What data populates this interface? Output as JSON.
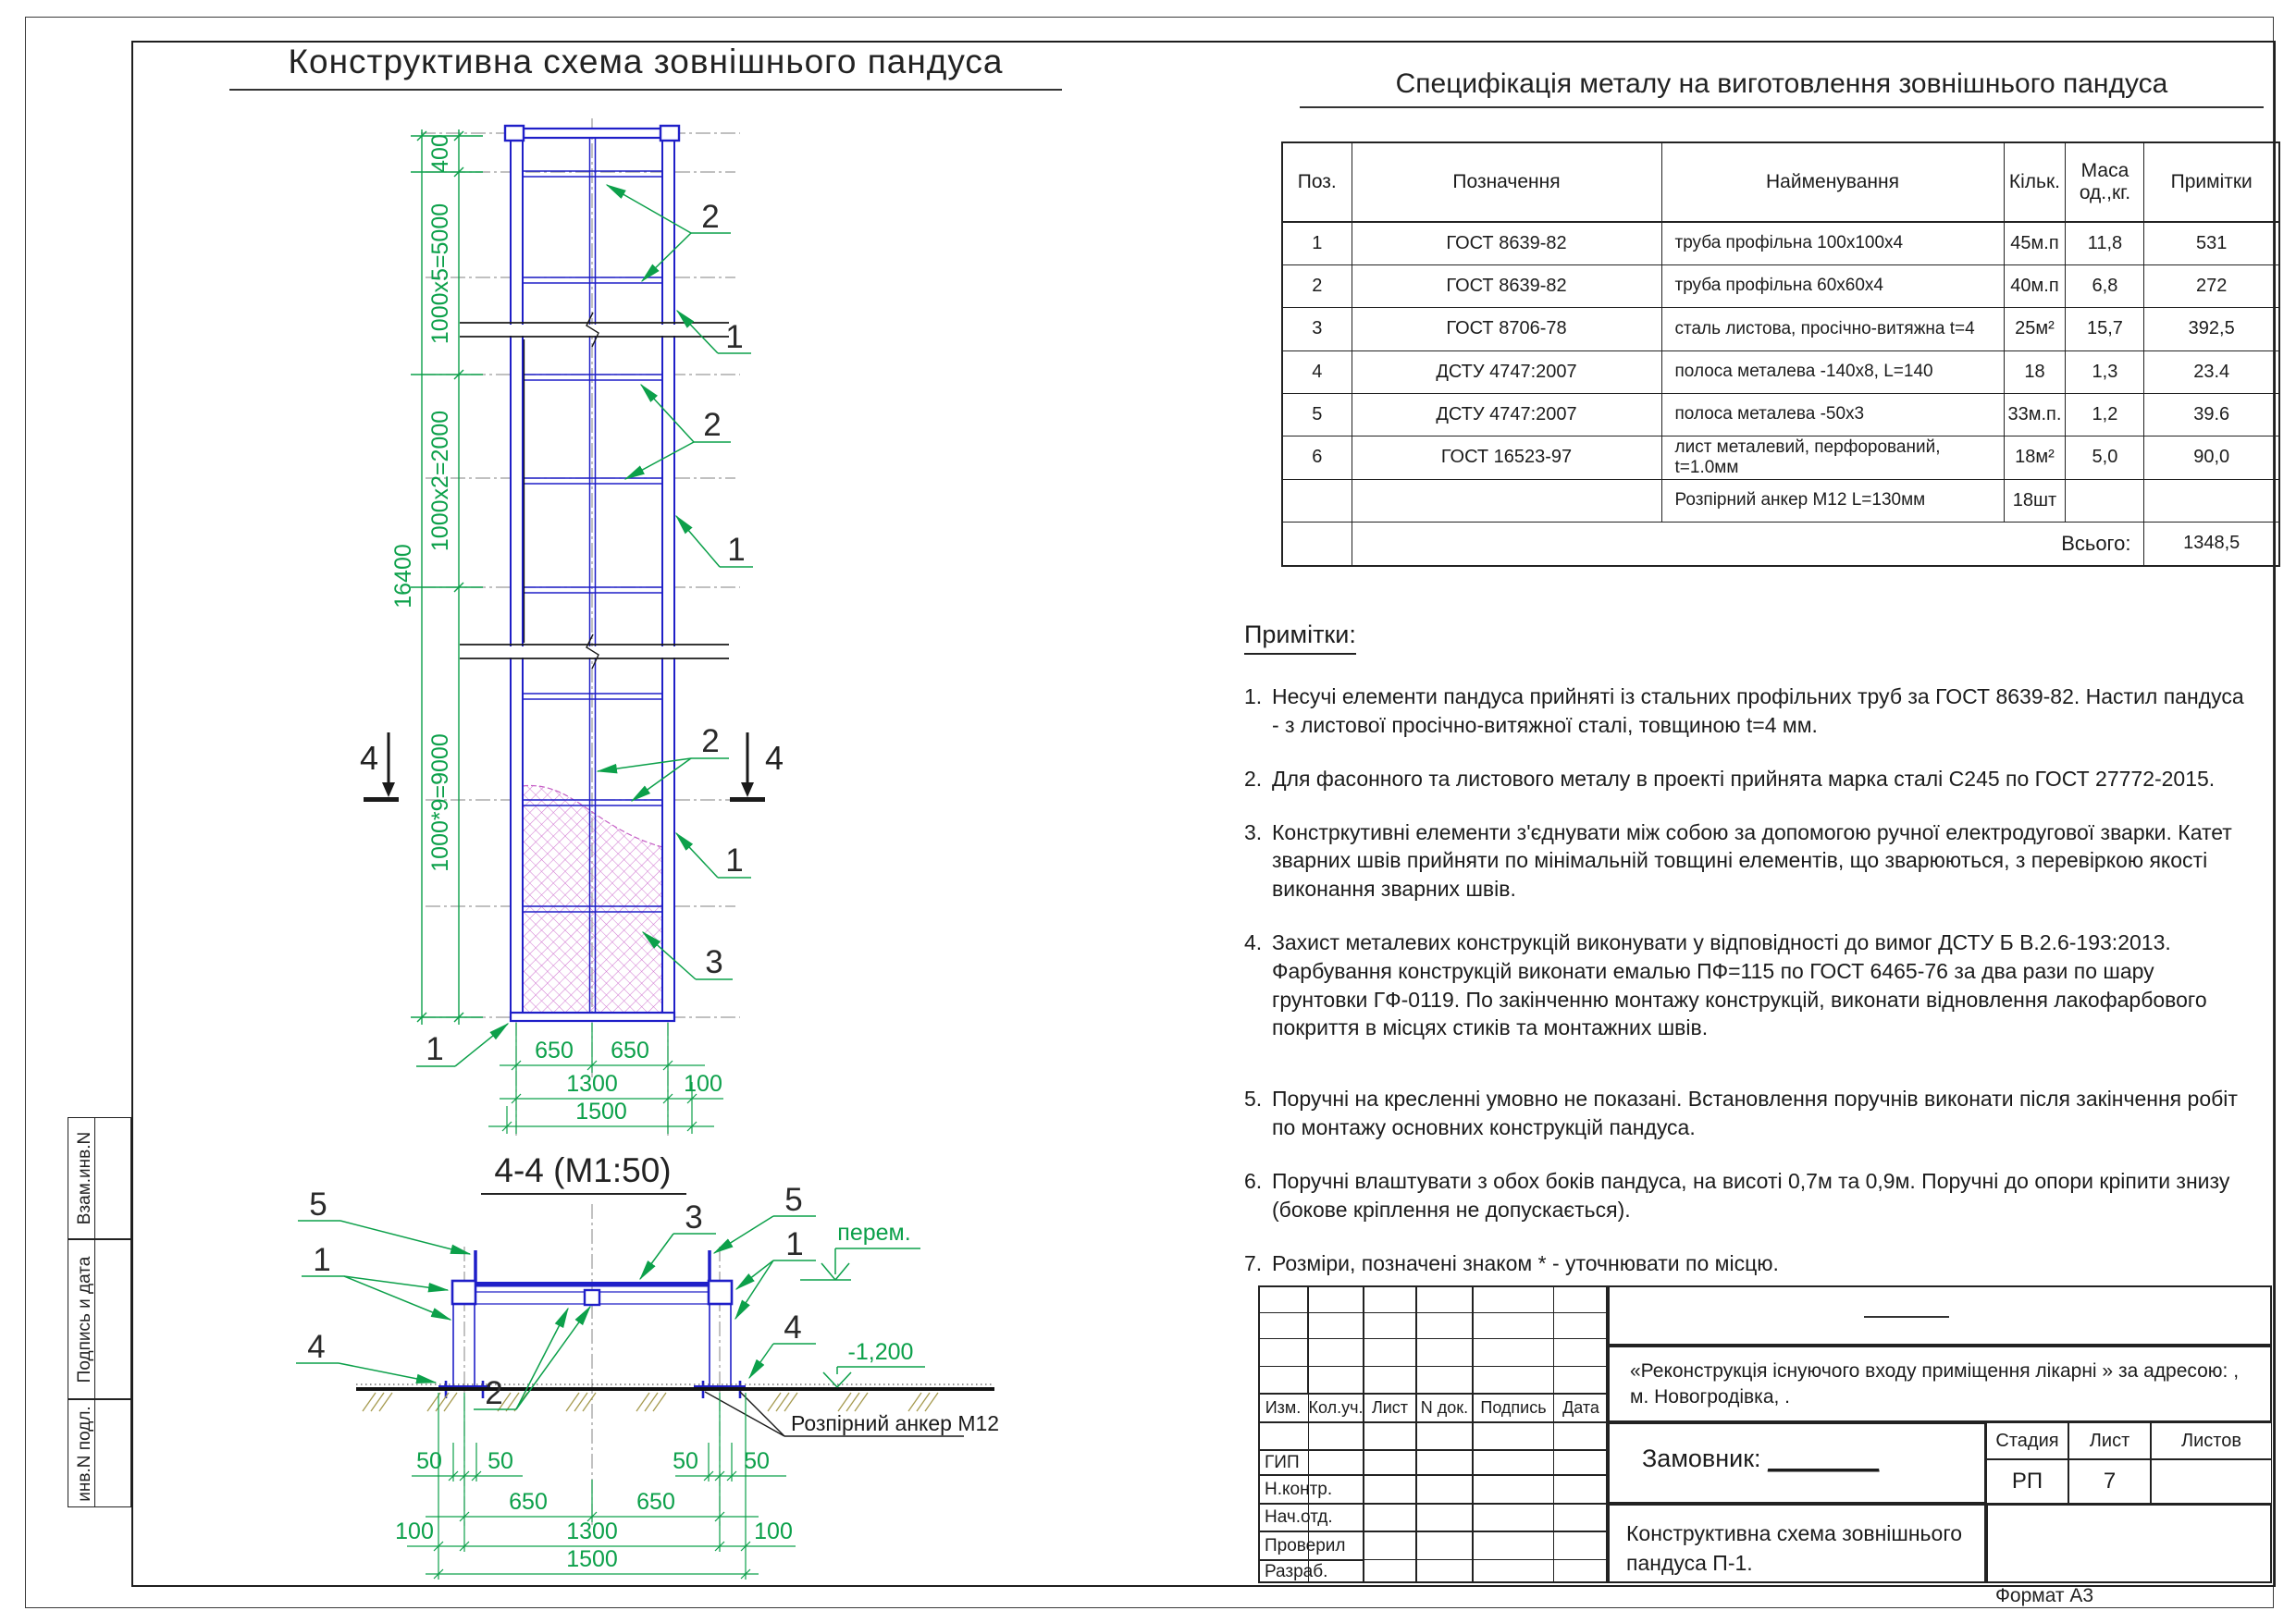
{
  "sheet": {
    "main_title": "Конструктивна схема зовнішнього пандуса",
    "format_label": "Формат А3"
  },
  "side_stamps": {
    "s1": "Взам.инв.N",
    "s2": "Подпись и дата",
    "s3": "инв.N подл."
  },
  "spec_table": {
    "title": "Специфікація металу на виготовлення зовнішнього пандуса",
    "headers": {
      "pos": "Поз.",
      "designation": "Позначення",
      "name": "Найменування",
      "qty": "Кільк.",
      "mass": "Маса од.,кг.",
      "notes": "Примітки"
    },
    "rows": [
      {
        "pos": "1",
        "designation": "ГОСТ 8639-82",
        "name": "труба профільна  100х100х4",
        "qty": "45м.п",
        "mass": "11,8",
        "notes": "531"
      },
      {
        "pos": "2",
        "designation": "ГОСТ 8639-82",
        "name": "труба профільна  60х60х4",
        "qty": "40м.п",
        "mass": "6,8",
        "notes": "272"
      },
      {
        "pos": "3",
        "designation": "ГОСТ 8706-78",
        "name": "сталь листова, просічно-витяжна t=4",
        "qty": "25м²",
        "mass": "15,7",
        "notes": "392,5"
      },
      {
        "pos": "4",
        "designation": "ДСТУ 4747:2007",
        "name": "полоса металева -140х8, L=140",
        "qty": "18",
        "mass": "1,3",
        "notes": "23.4"
      },
      {
        "pos": "5",
        "designation": "ДСТУ 4747:2007",
        "name": "полоса металева -50х3",
        "qty": "33м.п.",
        "mass": "1,2",
        "notes": "39.6"
      },
      {
        "pos": "6",
        "designation": "ГОСТ 16523-97",
        "name": "лист металевий, перфорований, t=1.0мм",
        "qty": "18м²",
        "mass": "5,0",
        "notes": "90,0"
      },
      {
        "pos": "",
        "designation": "",
        "name": "Розпірний анкер М12 L=130мм",
        "qty": "18шт",
        "mass": "",
        "notes": ""
      }
    ],
    "total_label": "Всього:",
    "total_value": "1348,5"
  },
  "notes": {
    "title": "Примітки:",
    "items": [
      {
        "num": "1.",
        "text": "Несучі елементи пандуса прийняті із стальних профільних труб за ГОСТ 8639-82. Настил пандуса - з листової просічно-витяжної сталі, товщиною t=4 мм."
      },
      {
        "num": "2.",
        "text": "Для фасонного та листового металу в проекті прийнята марка сталі С245 по ГОСТ 27772-2015."
      },
      {
        "num": "3.",
        "text": "Констркутивні елементи з'єднувати між собою за допомогою ручної електродугової зварки. Катет зварних швів прийняти по мінімальній товщині елементів, що зварюються, з перевіркою якості виконання зварних швів."
      },
      {
        "num": "4.",
        "text": "Захист металевих конструкцій виконувати у відповідності до вимог ДСТУ Б В.2.6-193:2013. Фарбування конструкцій виконати емалью ПФ=115 по ГОСТ 6465-76 за два рази по шару грунтовки ГФ-0119. По закінченню монтажу конструкцій, виконати відновлення лакофарбового покриття в місцях стиків та монтажних швів."
      },
      {
        "num": "5.",
        "text": "Поручні на кресленні умовно не показані. Встановлення поручнів виконати після закінчення робіт по монтажу основних конструкцій пандуса."
      },
      {
        "num": "6.",
        "text": "Поручні влаштувати з обох боків пандуса, на висоті 0,7м та 0,9м. Поручні до опори  кріпити знизу (бокове кріплення не допускається)."
      },
      {
        "num": "7.",
        "text": "Розміри, позначені знаком * - уточнювати по місцю."
      }
    ]
  },
  "labels": {
    "n1": "1",
    "n2": "2",
    "n3": "3",
    "n4": "4",
    "n5": "5"
  },
  "elevation": {
    "dim_400": "400",
    "dim_5000": "1000х5=5000",
    "dim_2000": "1000х2=2000",
    "dim_9000": "1000*9=9000",
    "dim_total": "16400",
    "dim_650": "650",
    "dim_1300": "1300",
    "dim_100": "100",
    "dim_1500": "1500"
  },
  "section": {
    "title": "4-4 (М1:50)",
    "dim_50": "50",
    "dim_650": "650",
    "dim_100": "100",
    "dim_1300": "1300",
    "dim_1500": "1500",
    "level_top": "перем.",
    "level_bottom": "-1,200",
    "anchor_label": "Розпірний анкер М12"
  },
  "title_block": {
    "header_cols": {
      "c1": "Изм.",
      "c2": "Кол.уч.",
      "c3": "Лист",
      "c4": "N док.",
      "c5": "Подпись",
      "c6": "Дата"
    },
    "sign_rows": {
      "r1": "ГИП",
      "r2": "Н.контр.",
      "r3": "Нач.отд.",
      "r4": "Проверил",
      "r5": "Разраб."
    },
    "project_line1": "«Реконструкція існуючого входу приміщення лікарні » за адресою: ,",
    "project_line2": "м. Новогродівка, .",
    "customer_label": "Замовник:",
    "customer_value": "________",
    "stage_label": "Стадия",
    "sheet_label": "Лист",
    "sheets_label": "Листов",
    "stage_value": "РП",
    "sheet_value": "7",
    "theme_line1": "Конструктивна схема зовнішнього",
    "theme_line2": "пандуса П-1."
  },
  "colors": {
    "structure_blue": "#1f1fc8",
    "dimension_green": "#0ca04a",
    "mesh_magenta": "#c55fc5",
    "centerline_grey": "#9a9a9a",
    "ground_khaki": "#a59a4e"
  }
}
